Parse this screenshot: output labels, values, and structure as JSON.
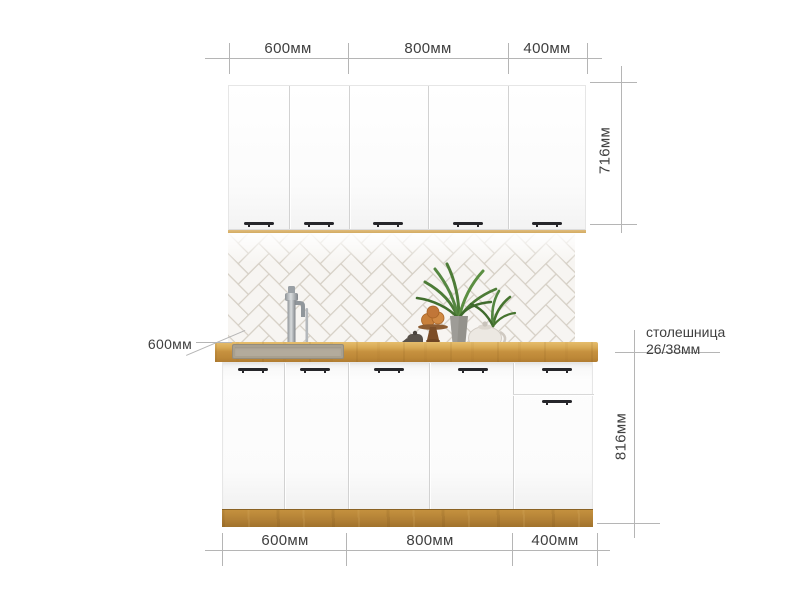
{
  "diagram_type": "kitchen-set-dimension-diagram",
  "dimensions": {
    "top_segments": [
      "600мм",
      "800мм",
      "400мм"
    ],
    "bottom_segments": [
      "600мм",
      "800мм",
      "400мм"
    ],
    "upper_cabinets_height": "716мм",
    "base_cabinets_height": "816мм",
    "worktop_depth": "600мм",
    "worktop_note_line1": "столешница",
    "worktop_note_line2": "26/38мм"
  },
  "colors": {
    "worktop_wood": "#c9953f",
    "plinth_wood": "#b07c34",
    "cabinet_white": "#fbfbfb",
    "tile_fill": "#f7f5f2",
    "tile_grout": "#d5cfc5",
    "dimension_line": "#b5b5b5",
    "annotation_text": "#3f3f3f",
    "handle": "#26262a",
    "plant_green": "#4d7c37",
    "chrome": "#9da2a6"
  }
}
